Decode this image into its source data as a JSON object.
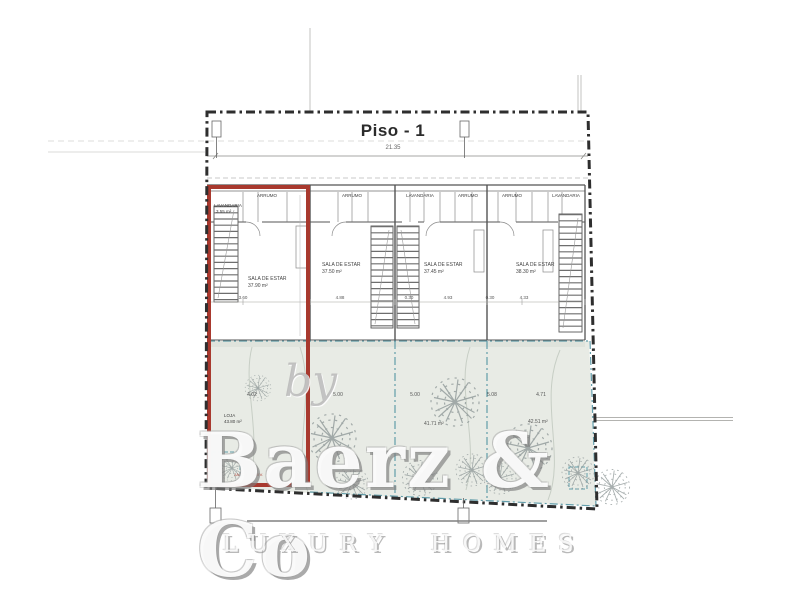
{
  "title": "Piso - 1",
  "overall_dim": "21.35",
  "units": [
    {
      "rooms": [
        {
          "label": "LAVANDARIA",
          "area": "3.55 m²"
        },
        {
          "label": "ARRUMO",
          "area": ""
        }
      ],
      "sala": {
        "label": "SALA DE ESTAR",
        "area": "37.90 m²"
      },
      "garden": {
        "label": "LOJA",
        "area": "43.80 m²"
      },
      "garden_note": "JARDIM PRIV."
    },
    {
      "rooms": [
        {
          "label": "ARRUMO",
          "area": ""
        }
      ],
      "sala": {
        "label": "SALA DE ESTAR",
        "area": "37.50 m²"
      },
      "garden": {
        "label": "",
        "area": ""
      }
    },
    {
      "rooms": [
        {
          "label": "LAVANDARIA",
          "area": ""
        },
        {
          "label": "ARRUMO",
          "area": ""
        }
      ],
      "sala": {
        "label": "SALA DE ESTAR",
        "area": "37.45 m²"
      },
      "garden": {
        "label": "",
        "area": "41.71 m²"
      }
    },
    {
      "rooms": [
        {
          "label": "ARRUMO",
          "area": ""
        },
        {
          "label": "LAVANDARIA",
          "area": ""
        }
      ],
      "sala": {
        "label": "SALA DE ESTAR",
        "area": "38.30 m²"
      },
      "garden": {
        "label": "",
        "area": "42.51 m²"
      }
    }
  ],
  "garden_dims": [
    "4.02",
    "5.00",
    "5.00",
    "5.08",
    "4.71"
  ],
  "interior_dims": [
    "3.60",
    "4.88",
    "0.30",
    "4.93",
    "0.30",
    "4.33"
  ],
  "watermark": {
    "by": "by",
    "brand": "Baerz & Co",
    "tagline": "LUXURY HOMES"
  },
  "colors": {
    "highlight_red": "#A8392E",
    "parcel_teal": "#4A8F9F",
    "boundary_black": "#2E2E2E",
    "garden_fill": "#E8EBE5"
  }
}
